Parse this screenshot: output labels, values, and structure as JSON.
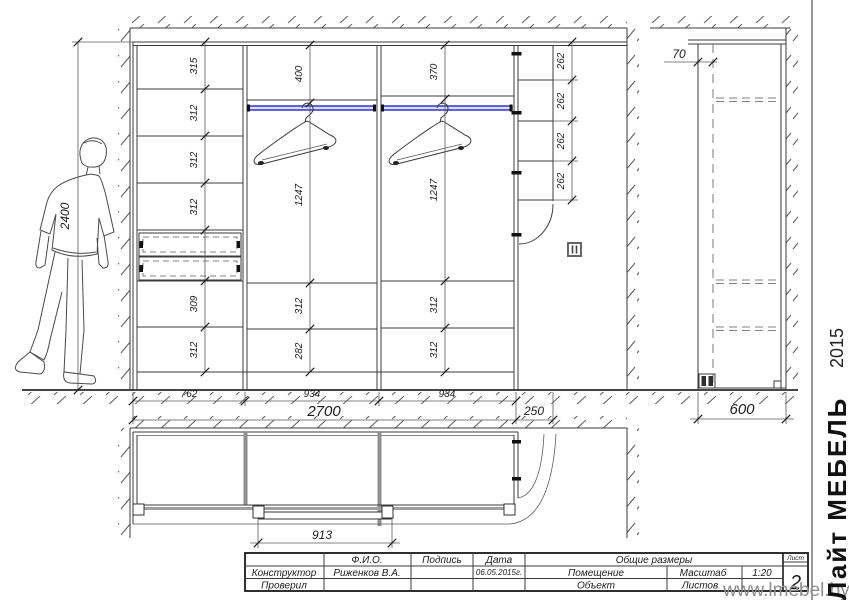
{
  "branding": {
    "company": "Лайт МЕБЕЛЬ",
    "year": "2015",
    "website": "www.lmebel.by"
  },
  "title_block": {
    "fio_header": "Ф.И.О.",
    "signature_header": "Подпись",
    "date_header": "Дата",
    "summary_header": "Общие размеры",
    "designer_label": "Конструктор",
    "designer_name": "Риженков В.А.",
    "date_value": "06.05.2015г.",
    "room_label": "Помещение",
    "scale_label": "Масштаб",
    "scale_value": "1:20",
    "checked_label": "Проверил",
    "object_label": "Объект",
    "sheets_label": "Листов",
    "sheet_label": "Лист",
    "sheet_number": "2"
  },
  "front_view": {
    "total_height": "2400",
    "section_widths": [
      "762",
      "934",
      "934"
    ],
    "total_width": "2700",
    "corner_unit_width": "250",
    "left_section_dims": [
      "315",
      "312",
      "312",
      "312",
      "309",
      "312"
    ],
    "middle_section_dims": [
      "400",
      "1247",
      "312",
      "282"
    ],
    "right_section_dims": [
      "370",
      "1247",
      "312",
      "312"
    ],
    "corner_shelf_dims": [
      "262",
      "262",
      "262",
      "262"
    ]
  },
  "side_view": {
    "door_offset": "70",
    "depth": "600"
  },
  "plan_view": {
    "door_width": "913"
  }
}
